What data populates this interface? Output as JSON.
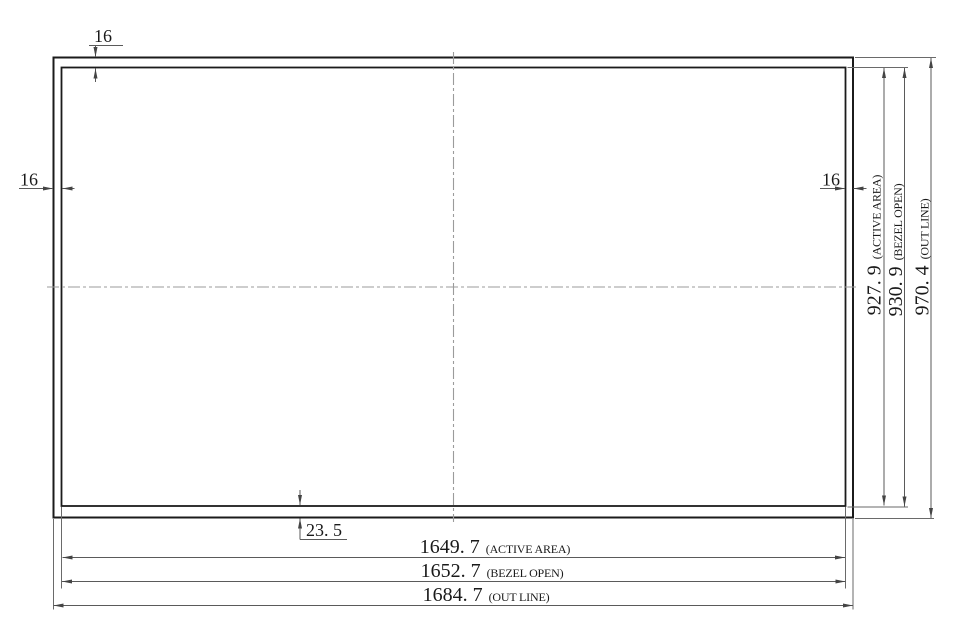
{
  "drawing": {
    "bezel": {
      "top": "16",
      "left": "16",
      "right": "16",
      "bottom": "23. 5"
    },
    "width_dims": [
      {
        "value": "1649. 7",
        "label": "(ACTIVE AREA)"
      },
      {
        "value": "1652. 7",
        "label": "(BEZEL OPEN)"
      },
      {
        "value": "1684. 7",
        "label": "(OUT LINE)"
      }
    ],
    "height_dims": [
      {
        "value": "927. 9",
        "label": "(ACTIVE AREA)"
      },
      {
        "value": "930. 9",
        "label": "(BEZEL OPEN)"
      },
      {
        "value": "970. 4",
        "label": "(OUT LINE)"
      }
    ],
    "colors": {
      "panel_line": "#1b1b1b",
      "dimension_line": "#5a5a5a",
      "centerline": "#9b9b9b",
      "text": "#1a1a1a",
      "background": "#ffffff"
    }
  }
}
